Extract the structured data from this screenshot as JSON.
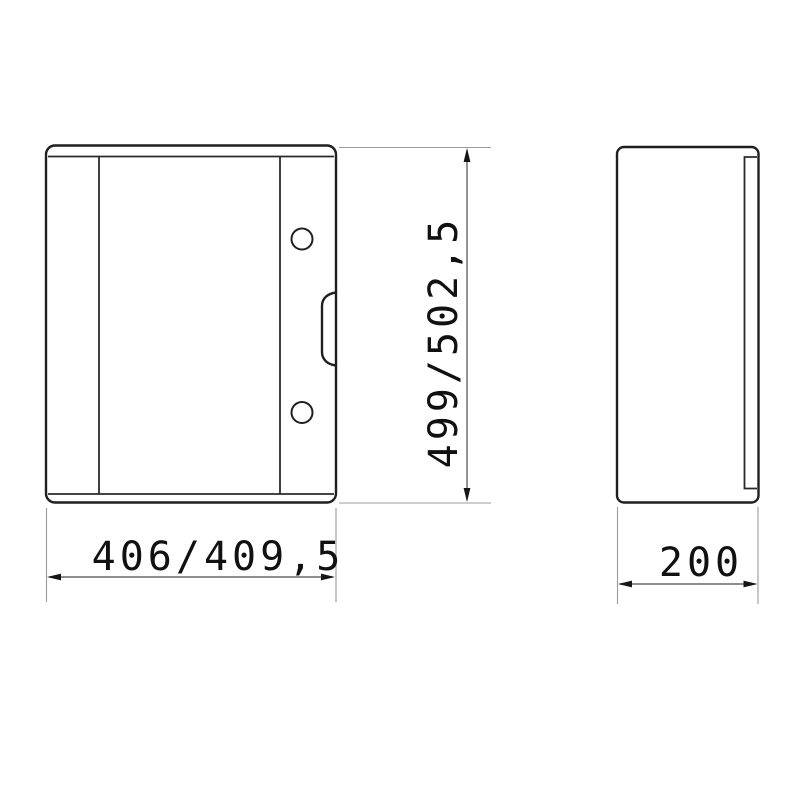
{
  "canvas": {
    "background": "#ffffff"
  },
  "drawing": {
    "kind": "technical-dimension-drawing",
    "views": {
      "front": {
        "name": "front-view",
        "hole_count": 2,
        "has_handle_recess": true
      },
      "side": {
        "name": "side-view",
        "has_door_edge_line": true
      }
    },
    "dimensions": {
      "height": {
        "label": "499/502,5",
        "orientation": "vertical",
        "view": "front"
      },
      "width": {
        "label": "406/409,5",
        "orientation": "horizontal",
        "view": "front"
      },
      "depth": {
        "label": "200",
        "orientation": "horizontal",
        "view": "side"
      }
    },
    "colors": {
      "object_line": "#1f1f1f",
      "extension_line": "#9b9b9b",
      "dimension_line": "#4a4a4a",
      "text": "#111111",
      "background": "#ffffff"
    }
  }
}
